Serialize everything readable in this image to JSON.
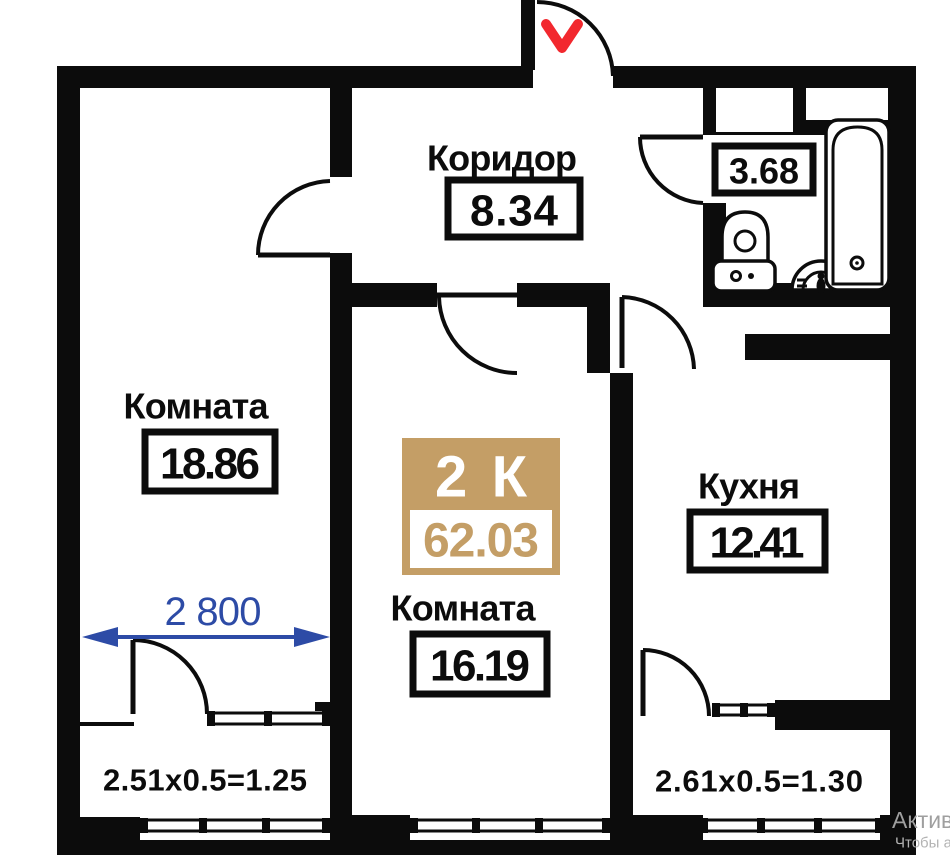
{
  "plan": {
    "corridor": {
      "name": "Коридор",
      "area": "8.34"
    },
    "room_left": {
      "name": "Комната",
      "area": "18.86"
    },
    "room_center": {
      "name": "Комната",
      "area": "16.19"
    },
    "kitchen": {
      "name": "Кухня",
      "area": "12.41"
    },
    "bathroom": {
      "area": "3.68"
    },
    "badge": {
      "type": "2 К",
      "total_area": "62.03"
    },
    "dimension": {
      "width_label": "2 800"
    },
    "balcony_left": {
      "formula": "2.51x0.5=1.25"
    },
    "balcony_right": {
      "formula": "2.61x0.5=1.30"
    }
  },
  "watermark": {
    "line1": "Актива",
    "line2": "Чтобы а"
  },
  "icons": {
    "entrance": "entrance-chevron-icon",
    "toilet": "toilet-icon",
    "sink": "sink-icon",
    "bathtub": "bathtub-icon",
    "dimension_arrow": "dimension-arrow-icon"
  },
  "colors": {
    "wall": "#0c0c0c",
    "badge_gold": "#c49e66",
    "dimension_blue": "#2d4ba6",
    "entry_red": "#f2282e",
    "watermark_gray": "#9f9f9f",
    "watermark_gray_light": "#b3b3b3"
  }
}
